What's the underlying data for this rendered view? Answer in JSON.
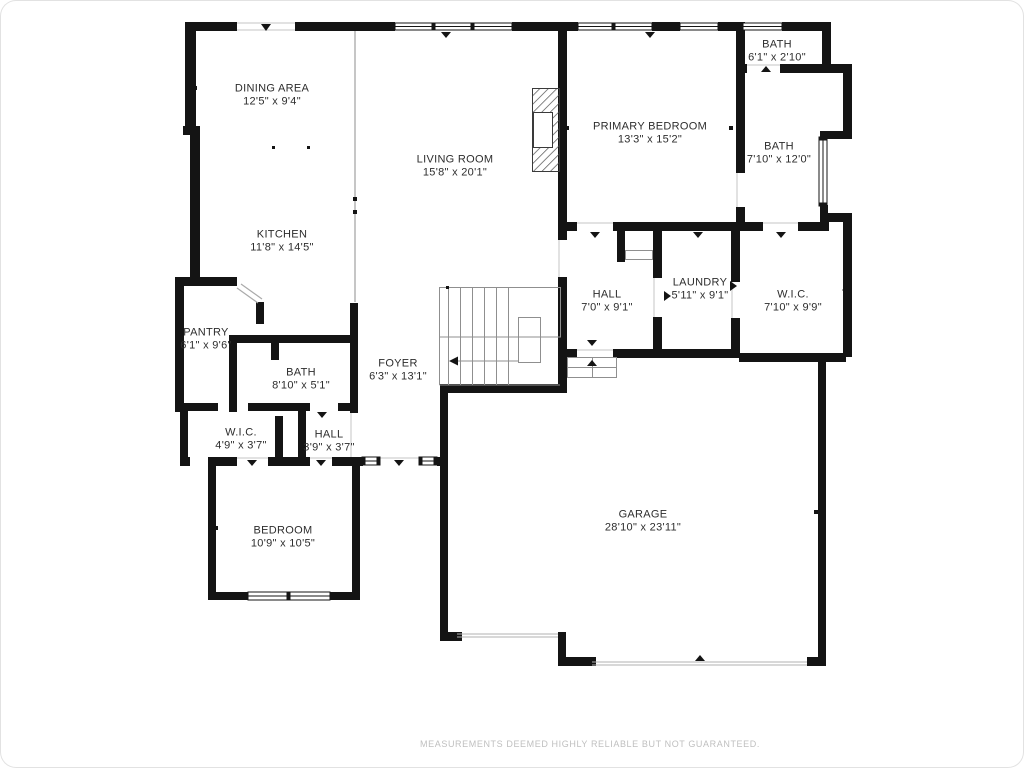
{
  "page": {
    "background": "#ffffff",
    "disclaimer": "MEASUREMENTS DEEMED HIGHLY RELIABLE BUT NOT GUARANTEED."
  },
  "floor_plan": {
    "wall_color": "#141414",
    "thin_line_color": "#9a9a9a",
    "rooms": [
      {
        "id": "dining-area",
        "label": "DINING AREA",
        "dims": "12'5\" x 9'4\"",
        "cx": 272,
        "cy": 95
      },
      {
        "id": "living-room",
        "label": "LIVING ROOM",
        "dims": "15'8\" x 20'1\"",
        "cx": 455,
        "cy": 166
      },
      {
        "id": "primary-bedroom",
        "label": "PRIMARY BEDROOM",
        "dims": "13'3\" x 15'2\"",
        "cx": 650,
        "cy": 133
      },
      {
        "id": "bath-top",
        "label": "BATH",
        "dims": "6'1\" x 2'10\"",
        "cx": 777,
        "cy": 51
      },
      {
        "id": "bath-right",
        "label": "BATH",
        "dims": "7'10\" x 12'0\"",
        "cx": 779,
        "cy": 153
      },
      {
        "id": "kitchen",
        "label": "KITCHEN",
        "dims": "11'8\" x 14'5\"",
        "cx": 282,
        "cy": 241
      },
      {
        "id": "hall-upper",
        "label": "HALL",
        "dims": "7'0\" x 9'1\"",
        "cx": 607,
        "cy": 301
      },
      {
        "id": "laundry",
        "label": "LAUNDRY",
        "dims": "5'11\" x 9'1\"",
        "cx": 700,
        "cy": 289
      },
      {
        "id": "wic-primary",
        "label": "W.I.C.",
        "dims": "7'10\" x 9'9\"",
        "cx": 793,
        "cy": 301
      },
      {
        "id": "pantry",
        "label": "PANTRY",
        "dims": "6'1\" x 9'6\"",
        "cx": 206,
        "cy": 339
      },
      {
        "id": "bath-middle",
        "label": "BATH",
        "dims": "8'10\" x 5'1\"",
        "cx": 301,
        "cy": 379
      },
      {
        "id": "foyer",
        "label": "FOYER",
        "dims": "6'3\" x 13'1\"",
        "cx": 398,
        "cy": 370
      },
      {
        "id": "wic-lower",
        "label": "W.I.C.",
        "dims": "4'9\" x 3'7\"",
        "cx": 241,
        "cy": 439
      },
      {
        "id": "hall-lower",
        "label": "HALL",
        "dims": "3'9\" x 3'7\"",
        "cx": 329,
        "cy": 441
      },
      {
        "id": "bedroom",
        "label": "BEDROOM",
        "dims": "10'9\" x 10'5\"",
        "cx": 283,
        "cy": 537
      },
      {
        "id": "garage",
        "label": "GARAGE",
        "dims": "28'10\" x 23'11\"",
        "cx": 643,
        "cy": 521
      }
    ]
  }
}
